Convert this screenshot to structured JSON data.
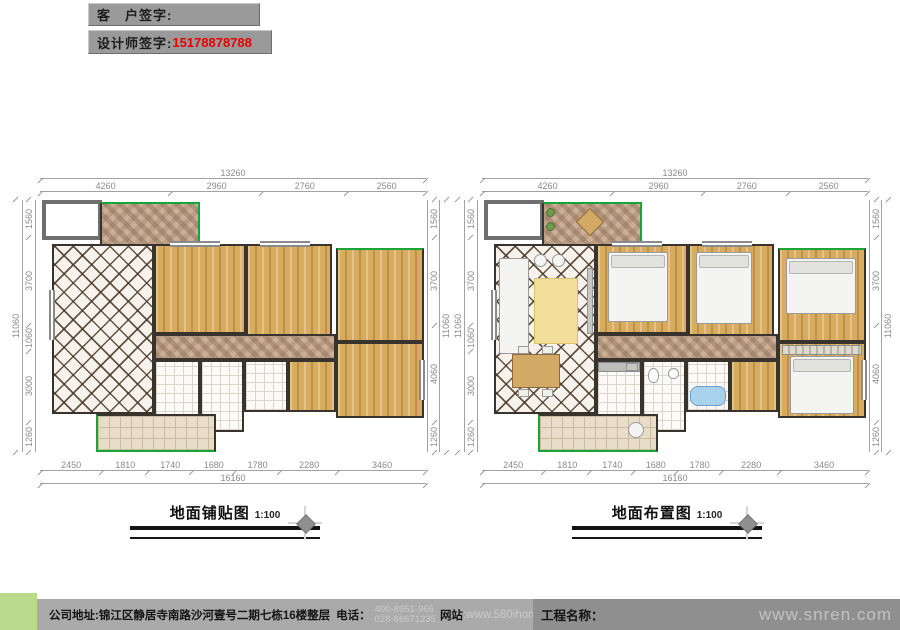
{
  "header": {
    "customer_sign_label": "客　户签字:",
    "designer_sign_label": "设计师签字:",
    "designer_phone": "15178878788"
  },
  "plans": [
    {
      "title": "地面铺贴图",
      "scale": "1:100",
      "dims": {
        "top_total": "13260",
        "top": [
          "4260",
          "2960",
          "2760",
          "2560"
        ],
        "bottom": [
          "2450",
          "1810",
          "1740",
          "1680",
          "1780",
          "2280",
          "3460"
        ],
        "bottom_total": "16160",
        "left": [
          "1560",
          "3700",
          "1060",
          "3000",
          "1260"
        ],
        "left_total": "11060",
        "right": [
          "1560",
          "3700",
          "4060",
          "1260"
        ],
        "right_total": "11060"
      }
    },
    {
      "title": "地面布置图",
      "scale": "1:100",
      "dims": {
        "top_total": "13260",
        "top": [
          "4260",
          "2960",
          "2760",
          "2560"
        ],
        "bottom": [
          "2450",
          "1810",
          "1740",
          "1680",
          "1780",
          "2280",
          "3460"
        ],
        "bottom_total": "16160",
        "left": [
          "1560",
          "3700",
          "1060",
          "3000",
          "1260"
        ],
        "left_total": "11060",
        "right": [
          "1560",
          "3700",
          "4060",
          "1260"
        ],
        "right_total": "11060"
      }
    }
  ],
  "footer": {
    "address_label": "公司地址:",
    "address": "锦江区静居寺南路沙河壹号二期七栋16楼整层",
    "phone_label": "电话：",
    "phone1": "400-8951-966",
    "phone2": "028-86671235",
    "website_label": "网站",
    "website_value": ":www.580ihome.com",
    "project_label": "工程名称：",
    "watermark": "www.snren.com"
  },
  "colors": {
    "accent_green": "#17a53a",
    "phone_red": "#e60000",
    "footer_green": "#b9d98b",
    "signature_gray": "#9a9a9a"
  }
}
